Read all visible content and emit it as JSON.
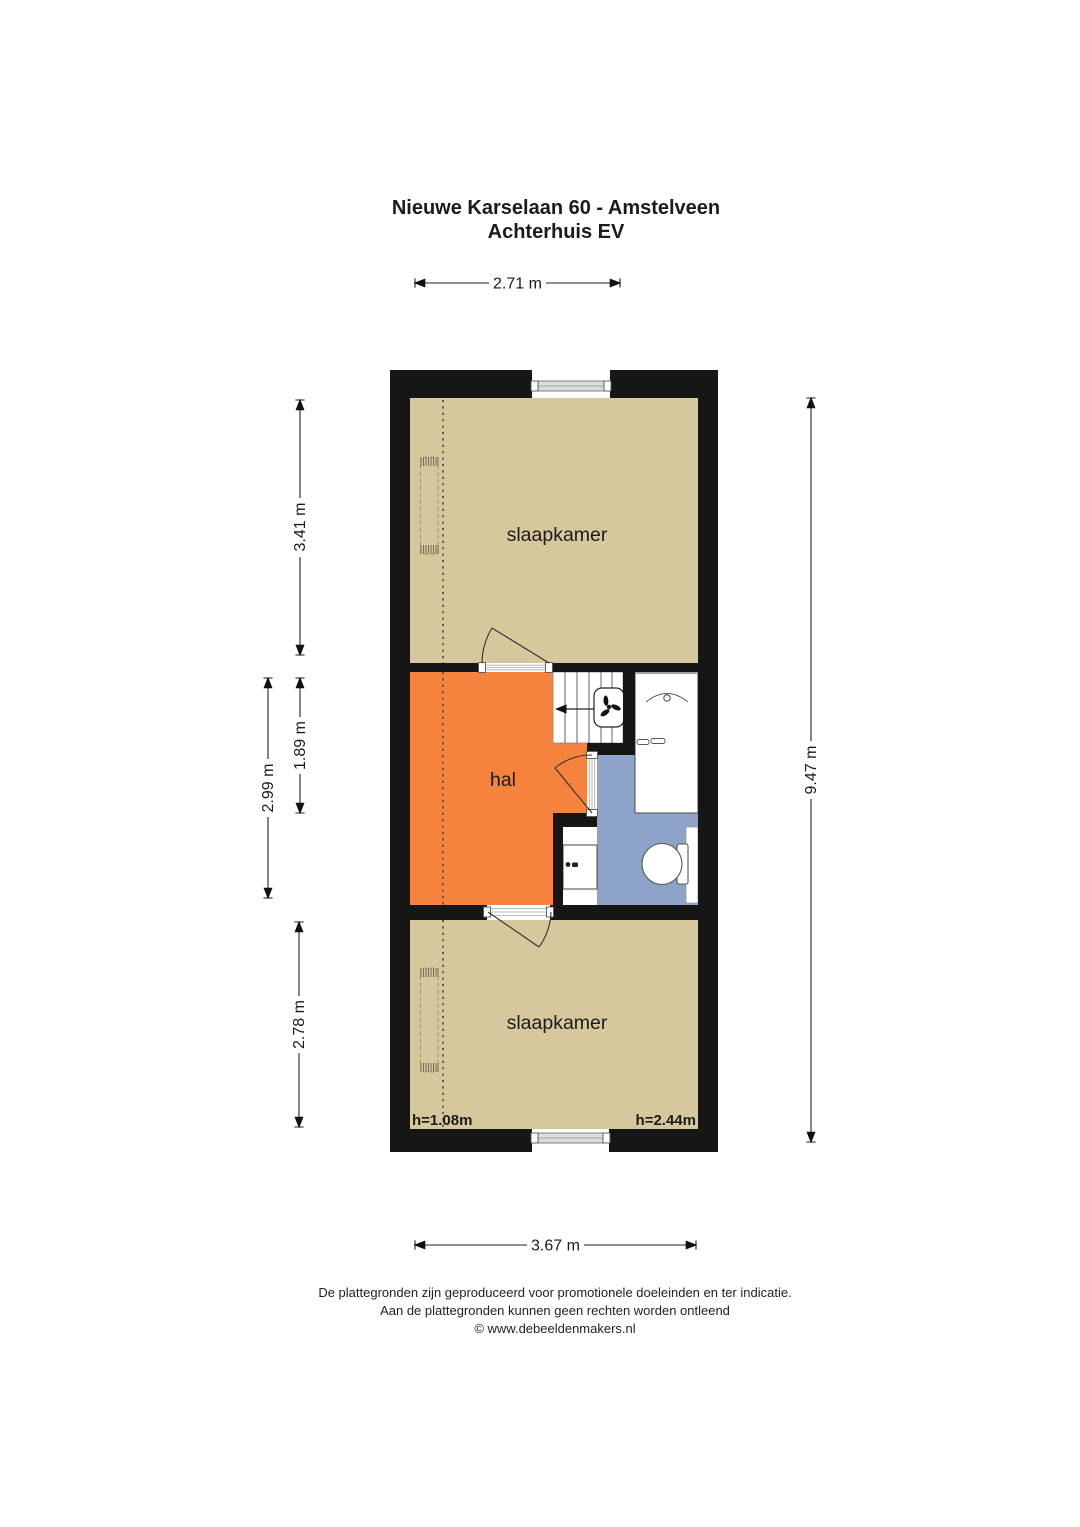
{
  "title": {
    "line1": "Nieuwe Karselaan 60 - Amstelveen",
    "line2": "Achterhuis EV"
  },
  "rooms": {
    "slaapkamer_top": "slaapkamer",
    "hal": "hal",
    "slaapkamer_bottom": "slaapkamer"
  },
  "height_labels": {
    "left": "h=1.08m",
    "right": "h=2.44m"
  },
  "dimensions": {
    "top_width": "2.71 m",
    "left_top": "3.41 m",
    "left_hal_outer": "2.99 m",
    "left_hal_inner": "1.89 m",
    "left_bottom": "2.78 m",
    "right_total": "9.47 m",
    "bottom_width": "3.67 m"
  },
  "footer": {
    "line1": "De plattegronden zijn geproduceerd voor promotionele doeleinden en ter indicatie.",
    "line2": "Aan de plattegronden kunnen geen rechten worden ontleend",
    "line3": "© www.debeeldenmakers.nl"
  },
  "colors": {
    "wall": "#161616",
    "floor_beige": "#d6c79c",
    "floor_orange": "#f5833d",
    "floor_blue": "#8da4c8"
  }
}
